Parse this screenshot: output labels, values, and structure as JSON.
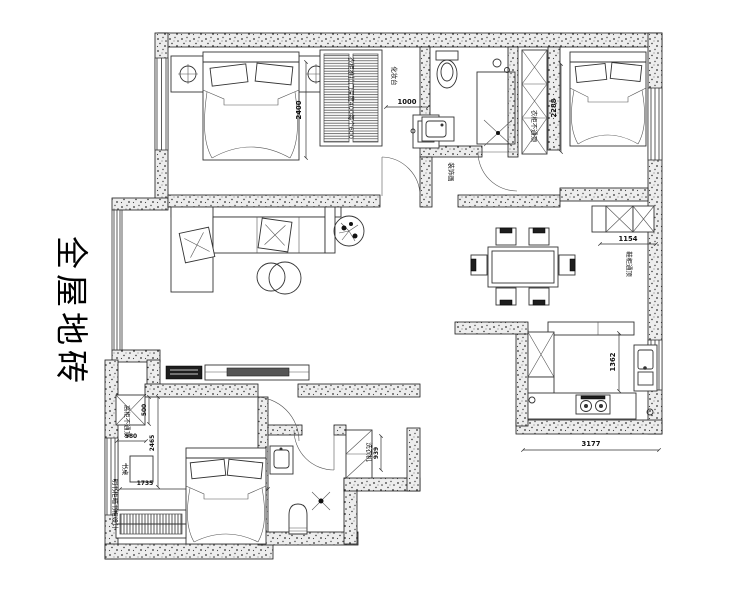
{
  "title_note": {
    "text": "全屋地砖"
  },
  "labels": {
    "wardrobe_note": "衣柜推拉门深度400每个600",
    "dresser": "化妆台",
    "decor_painting": "装饰画",
    "wardrobe_no_ceiling": "衣柜不通顶",
    "shoe_cabinet": "鞋柜通顶",
    "tall_cabinet": "高柜不通顶",
    "desk": "书桌",
    "bookcase_note": "明书柜暗书柜设计",
    "washer": "洗衣机"
  },
  "dimensions": {
    "bed1": "2400",
    "dresser": "1000",
    "bed2": "2288",
    "shoe_cabinet": "1154",
    "kitchen": "1362",
    "kitchen_width": "3177",
    "cabinet_h": "500",
    "cabinet_w": "580",
    "desk_wall": "2465",
    "bed3_wall": "1735",
    "laundry": "939"
  }
}
